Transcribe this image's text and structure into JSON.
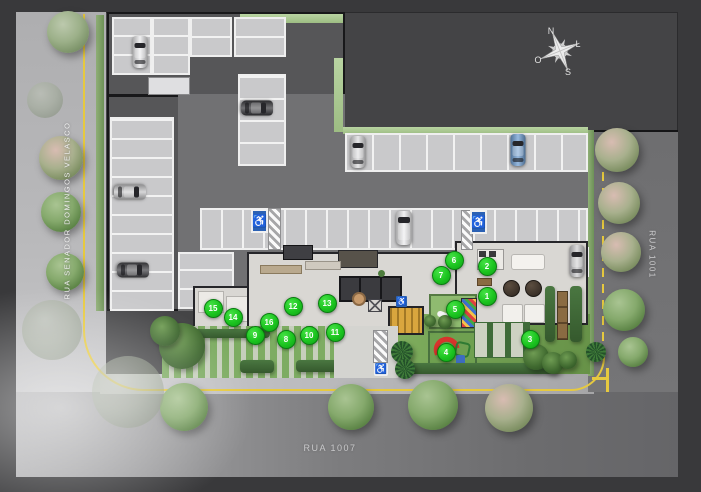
{
  "streets": {
    "left": "RUA SENADOR DOMINGOS VELASCO",
    "right": "RUA 1001",
    "bottom": "RUA 1007"
  },
  "compass": {
    "north": "N",
    "east": "L",
    "south": "S",
    "west": "O"
  },
  "legend_markers": [
    {
      "label": "1",
      "x": 486,
      "y": 295
    },
    {
      "label": "2",
      "x": 486,
      "y": 265
    },
    {
      "label": "3",
      "x": 529,
      "y": 338
    },
    {
      "label": "4",
      "x": 445,
      "y": 351
    },
    {
      "label": "5",
      "x": 454,
      "y": 308
    },
    {
      "label": "6",
      "x": 453,
      "y": 259
    },
    {
      "label": "7",
      "x": 440,
      "y": 274
    },
    {
      "label": "8",
      "x": 285,
      "y": 338
    },
    {
      "label": "9",
      "x": 254,
      "y": 334
    },
    {
      "label": "10",
      "x": 308,
      "y": 334
    },
    {
      "label": "11",
      "x": 334,
      "y": 331
    },
    {
      "label": "12",
      "x": 292,
      "y": 305
    },
    {
      "label": "13",
      "x": 326,
      "y": 302
    },
    {
      "label": "14",
      "x": 232,
      "y": 316
    },
    {
      "label": "15",
      "x": 212,
      "y": 307
    },
    {
      "label": "16",
      "x": 268,
      "y": 321
    }
  ],
  "colors": {
    "marker_green": "#1bc41f",
    "road_yellow": "#e6c93f",
    "handicap_blue": "#2b61b4"
  },
  "icons": {
    "accessible": "wheelchair-icon",
    "compass": "compass-rose-icon"
  },
  "accessible_spots": [
    {
      "x": 251,
      "y": 209,
      "type": "stall"
    },
    {
      "x": 470,
      "y": 210,
      "type": "stall"
    },
    {
      "x": 374,
      "y": 363,
      "type": "pavement"
    },
    {
      "x": 396,
      "y": 296,
      "type": "sign"
    }
  ],
  "hatched_ramps": [
    {
      "x": 268,
      "y": 208,
      "w": 13,
      "h": 42
    },
    {
      "x": 461,
      "y": 210,
      "w": 12,
      "h": 40
    },
    {
      "x": 373,
      "y": 330,
      "w": 15,
      "h": 33
    }
  ],
  "stall_groups": [
    {
      "x": 112,
      "y": 17,
      "w": 40,
      "h": 58,
      "o": "h",
      "p": 19
    },
    {
      "x": 152,
      "y": 17,
      "w": 38,
      "h": 58,
      "o": "h",
      "p": 19
    },
    {
      "x": 190,
      "y": 17,
      "w": 42,
      "h": 40,
      "o": "h",
      "p": 19
    },
    {
      "x": 234,
      "y": 17,
      "w": 52,
      "h": 40,
      "o": "h",
      "p": 19
    },
    {
      "x": 110,
      "y": 117,
      "w": 64,
      "h": 194,
      "o": "h",
      "p": 19
    },
    {
      "x": 238,
      "y": 74,
      "w": 48,
      "h": 92,
      "o": "h",
      "p": 22
    },
    {
      "x": 345,
      "y": 133,
      "w": 243,
      "h": 39,
      "o": "v",
      "p": 27
    },
    {
      "x": 200,
      "y": 208,
      "w": 388,
      "h": 42,
      "o": "v",
      "p": 21
    },
    {
      "x": 178,
      "y": 252,
      "w": 56,
      "h": 57,
      "o": "h",
      "p": 19
    },
    {
      "x": 556,
      "y": 247,
      "w": 33,
      "h": 30,
      "o": "v",
      "p": 16
    }
  ],
  "cars": [
    {
      "x": 140,
      "y": 52,
      "rot": 0,
      "color": "#e9e9eb",
      "type": "car"
    },
    {
      "x": 257,
      "y": 108,
      "rot": 90,
      "color": "#3a3a3e",
      "type": "car"
    },
    {
      "x": 130,
      "y": 192,
      "rot": 90,
      "color": "#c7c7c9",
      "type": "car"
    },
    {
      "x": 133,
      "y": 270,
      "rot": 90,
      "color": "#46464a",
      "type": "car"
    },
    {
      "x": 358,
      "y": 152,
      "rot": 0,
      "color": "#dedee0",
      "type": "car"
    },
    {
      "x": 518,
      "y": 150,
      "rot": 0,
      "color": "#6f9ed2",
      "type": "car"
    },
    {
      "x": 404,
      "y": 228,
      "rot": 0,
      "color": "#ececee",
      "type": "van"
    },
    {
      "x": 577,
      "y": 261,
      "rot": 0,
      "color": "#cdcdcf",
      "type": "car"
    }
  ],
  "trees": {
    "left": [
      {
        "x": 68,
        "y": 32,
        "r": 21,
        "v": "sage"
      },
      {
        "x": 61,
        "y": 158,
        "r": 22,
        "v": "pink"
      },
      {
        "x": 61,
        "y": 212,
        "r": 20,
        "v": "green"
      },
      {
        "x": 65,
        "y": 272,
        "r": 19,
        "v": "green"
      }
    ],
    "bottom": [
      {
        "x": 184,
        "y": 407,
        "r": 24,
        "v": "green"
      },
      {
        "x": 351,
        "y": 407,
        "r": 23,
        "v": "green"
      },
      {
        "x": 433,
        "y": 405,
        "r": 25,
        "v": "green"
      },
      {
        "x": 509,
        "y": 408,
        "r": 24,
        "v": "pink"
      }
    ],
    "right": [
      {
        "x": 617,
        "y": 150,
        "r": 22,
        "v": "pink"
      },
      {
        "x": 619,
        "y": 203,
        "r": 21,
        "v": "pink"
      },
      {
        "x": 621,
        "y": 252,
        "r": 20,
        "v": "pink"
      },
      {
        "x": 624,
        "y": 310,
        "r": 21,
        "v": "green"
      },
      {
        "x": 633,
        "y": 352,
        "r": 15,
        "v": "green"
      }
    ],
    "faded": [
      {
        "x": 52,
        "y": 330,
        "r": 30
      },
      {
        "x": 128,
        "y": 392,
        "r": 36
      },
      {
        "x": 45,
        "y": 100,
        "r": 18
      }
    ]
  },
  "bushes": [
    {
      "x": 182,
      "y": 346,
      "r": 23,
      "t": "bush"
    },
    {
      "x": 165,
      "y": 331,
      "r": 15,
      "t": "bush"
    },
    {
      "x": 402,
      "y": 352,
      "r": 11,
      "t": "palm"
    },
    {
      "x": 405,
      "y": 369,
      "r": 10,
      "t": "palm"
    },
    {
      "x": 536,
      "y": 357,
      "r": 13,
      "t": "bush"
    },
    {
      "x": 553,
      "y": 363,
      "r": 11,
      "t": "bush"
    },
    {
      "x": 568,
      "y": 360,
      "r": 9,
      "t": "bush"
    },
    {
      "x": 596,
      "y": 352,
      "r": 10,
      "t": "palm"
    },
    {
      "x": 445,
      "y": 322,
      "r": 7,
      "t": "bush"
    },
    {
      "x": 430,
      "y": 321,
      "r": 6,
      "t": "bush"
    }
  ]
}
